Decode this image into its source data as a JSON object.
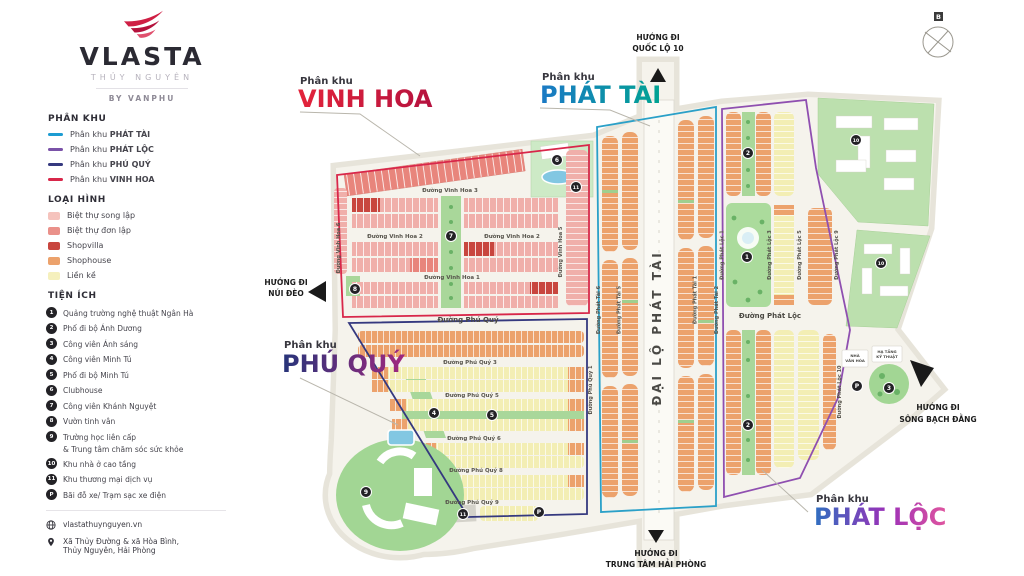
{
  "sidebar": {
    "logo": {
      "brand": "VLASTA",
      "sub": "THỦY NGUYÊN",
      "byline": "BY VANPHU"
    },
    "phan_khu": {
      "heading": "PHÂN KHU",
      "items": [
        {
          "prefix": "Phân khu",
          "name": "PHÁT TÀI",
          "color": "#1d9cd2"
        },
        {
          "prefix": "Phân khu",
          "name": "PHÁT LỘC",
          "color": "#7a52a8"
        },
        {
          "prefix": "Phân khu",
          "name": "PHÚ QUÝ",
          "color": "#35397f"
        },
        {
          "prefix": "Phân khu",
          "name": "VINH HOA",
          "color": "#d8274a"
        }
      ]
    },
    "loai_hinh": {
      "heading": "LOẠI HÌNH",
      "items": [
        {
          "label": "Biệt thự song lập",
          "color": "#f5c3bd"
        },
        {
          "label": "Biệt thự đơn lập",
          "color": "#ea918a"
        },
        {
          "label": "Shopvilla",
          "color": "#c8463e"
        },
        {
          "label": "Shophouse",
          "color": "#eca26c"
        },
        {
          "label": "Liền kề",
          "color": "#f5f0bd"
        }
      ]
    },
    "tien_ich": {
      "heading": "TIỆN ÍCH",
      "items": [
        {
          "marker": "1",
          "label": "Quảng trường nghệ thuật Ngân Hà"
        },
        {
          "marker": "2",
          "label": "Phố đi bộ Ánh Dương"
        },
        {
          "marker": "3",
          "label": "Công viên Ánh sáng"
        },
        {
          "marker": "4",
          "label": "Công viên Minh Tú"
        },
        {
          "marker": "5",
          "label": "Phố đi bộ Minh Tú"
        },
        {
          "marker": "6",
          "label": "Clubhouse"
        },
        {
          "marker": "7",
          "label": "Công viên Khánh Nguyệt"
        },
        {
          "marker": "8",
          "label": "Vườn tinh vân"
        },
        {
          "marker": "9",
          "label": "Trường học liên cấp",
          "label2": "& Trung tâm chăm sóc sức khỏe"
        },
        {
          "marker": "10",
          "label": "Khu nhà ở cao tầng"
        },
        {
          "marker": "11",
          "label": "Khu thương mại dịch vụ"
        },
        {
          "marker": "P",
          "label": "Bãi đỗ xe/ Trạm sạc xe điện"
        }
      ]
    },
    "contact": {
      "website": "vlastathuynguyen.vn",
      "address1": "Xã Thủy Đường & xã Hòa Bình,",
      "address2": "Thủy Nguyên, Hải Phòng"
    }
  },
  "map": {
    "compass_north": "B",
    "zone_labels": {
      "vinh_hoa": {
        "prefix": "Phân khu",
        "name": "VINH HOA"
      },
      "phat_tai": {
        "prefix": "Phân khu",
        "name": "PHÁT TÀI"
      },
      "phu_quy": {
        "prefix": "Phân khu",
        "name": "PHÚ QUÝ"
      },
      "phat_loc": {
        "prefix": "Phân khu",
        "name": "PHÁT LỘC"
      }
    },
    "directions": {
      "quoc_lo": {
        "l1": "HƯỚNG ĐI",
        "l2": "QUỐC LỘ 10"
      },
      "nui_deo": {
        "l1": "HƯỚNG ĐI",
        "l2": "NÚI ĐÈO"
      },
      "song_bach_dang": {
        "l1": "HƯỚNG ĐI",
        "l2": "SÔNG BẠCH ĐẰNG"
      },
      "hai_phong": {
        "l1": "HƯỚNG ĐI",
        "l2": "TRUNG TÂM HẢI PHÒNG"
      }
    },
    "streets": {
      "vh1": "Đường Vinh Hoa 1",
      "vh2": "Đường Vinh Hoa 2",
      "vh3": "Đường Vinh Hoa 3",
      "vh5": "Đường Vinh Hoa 5",
      "vh6": "Đường Vinh Hoa 6",
      "pq": "Đường Phú Quý",
      "pq1": "Đường Phú Quý 1",
      "pq3": "Đường Phú Quý 3",
      "pq5": "Đường Phú Quý 5",
      "pq6": "Đường Phú Quý 6",
      "pq8": "Đường Phú Quý 8",
      "pq9": "Đường Phú Quý 9",
      "dai_lo": "ĐẠI LỘ PHÁT TÀI",
      "pt1": "Đường Phát Tài 1",
      "pt2": "Đường Phát Tài 2",
      "pt5": "Đường Phát Tài 5",
      "pt6": "Đường Phát Tài 6",
      "pl": "Đường Phát Lộc",
      "pl1": "Đường Phát Lộc 1",
      "pl3": "Đường Phát Lộc 3",
      "pl5": "Đường Phát Lộc 5",
      "pl9": "Đường Phát Lộc 9",
      "pl10": "Đường Phát Lộc 10"
    },
    "facility_labels": {
      "nvh1": "NHÀ",
      "nvh2": "VĂN HÓA",
      "htkt1": "HẠ TẦNG",
      "htkt2": "KỸ THUẬT"
    },
    "markers": [
      "1",
      "2",
      "2",
      "3",
      "4",
      "5",
      "6",
      "7",
      "8",
      "9",
      "10",
      "10",
      "11",
      "11",
      "P",
      "P"
    ]
  }
}
